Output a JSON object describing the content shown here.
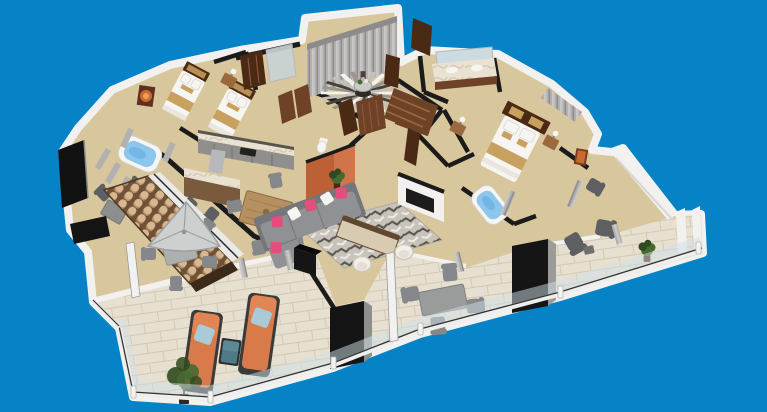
{
  "scene": {
    "type": "isometric-3d-floorplan-render",
    "background": "#0583c6",
    "palette": {
      "bg": "#0583c6",
      "wall": "#f2f1ef",
      "wallshade": "#d7d6d3",
      "dark": "#1b1b1b",
      "floor": "#d8c69d",
      "tile": "#e7e0d0",
      "tileline": "#d2c9b4",
      "wood": "#6e4226",
      "wooddark": "#4a2a15",
      "woodlight": "#9a6a3e",
      "cabinet": "#8f8f8d",
      "cabdark": "#57554e",
      "steel": "#b7b8ba",
      "sofa": "#8f9194",
      "sofadark": "#74767a",
      "pink": "#e44e7c",
      "white": "#f6f5f2",
      "rug": "#c7c3ba",
      "rugdark": "#59544b",
      "orange": "#bd6036",
      "orangehot": "#d0744a",
      "lounger": "#d97a4a",
      "bluepillow": "#a9cbd6",
      "teal": "#4d7a85",
      "teallight": "#62909b",
      "water": "#8cc6ec",
      "waterdeep": "#5fa8df",
      "runner": "#c8a160",
      "green": "#466b31",
      "greendark": "#30491f",
      "curtain": "#b3b1af",
      "umbrella": "#ced0cf",
      "chair": "#85878a",
      "chairdark": "#5d5f62",
      "glass": "#cfdfe8"
    },
    "rooms": [
      {
        "name": "entry-foyer",
        "furniture": [
          "feature-curtain-wall",
          "sunburst-rug",
          "round-entry-table",
          "flower-centerpiece",
          "wood-doors"
        ]
      },
      {
        "name": "guest-bedroom",
        "furniture": [
          "twin-bed",
          "twin-bed",
          "shared-nightstand",
          "table-lamp",
          "orange-wall-art",
          "wardrobe",
          "glass-shower"
        ]
      },
      {
        "name": "guest-balcony",
        "furniture": [
          "jacuzzi-tub",
          "armchairs",
          "side-table",
          "wall-tv",
          "curtains"
        ]
      },
      {
        "name": "kitchen",
        "furniture": [
          "cabinet-run",
          "refrigerator",
          "sink",
          "marble-bar-island",
          "bar-stools"
        ]
      },
      {
        "name": "dining-area",
        "furniture": [
          "wood-dining-table",
          "dining-chairs",
          "vase"
        ]
      },
      {
        "name": "living-room",
        "furniture": [
          "sectional-sofa",
          "pink-accent-pillows",
          "patterned-area-rug",
          "console-daybed",
          "barrel-chairs",
          "orange-accent-wall",
          "potted-plant",
          "wall-tv"
        ]
      },
      {
        "name": "guest-bathroom",
        "furniture": [
          "toilet"
        ]
      },
      {
        "name": "master-bedroom",
        "furniture": [
          "king-bed",
          "nightstand",
          "nightstand",
          "table-lamps",
          "orange-wall-art",
          "tv-console"
        ]
      },
      {
        "name": "master-bathroom",
        "furniture": [
          "double-vanity",
          "mirror"
        ]
      },
      {
        "name": "walk-in-closet",
        "furniture": [
          "wardrobe-shelving"
        ]
      },
      {
        "name": "master-terrace",
        "furniture": [
          "jacuzzi-tub",
          "privacy-curtains",
          "armchair"
        ]
      },
      {
        "name": "wraparound-terrace",
        "furniture": [
          "glass-balustrade",
          "umbrella-dining-set",
          "outdoor-dining-table",
          "armchair-pair",
          "potted-plant",
          "barrel-tile-roof-strip",
          "black-service-columns"
        ]
      },
      {
        "name": "sun-deck",
        "furniture": [
          "sun-lounger",
          "sun-lounger",
          "blue-cushions",
          "teal-side-table",
          "olive-tree"
        ]
      }
    ]
  }
}
